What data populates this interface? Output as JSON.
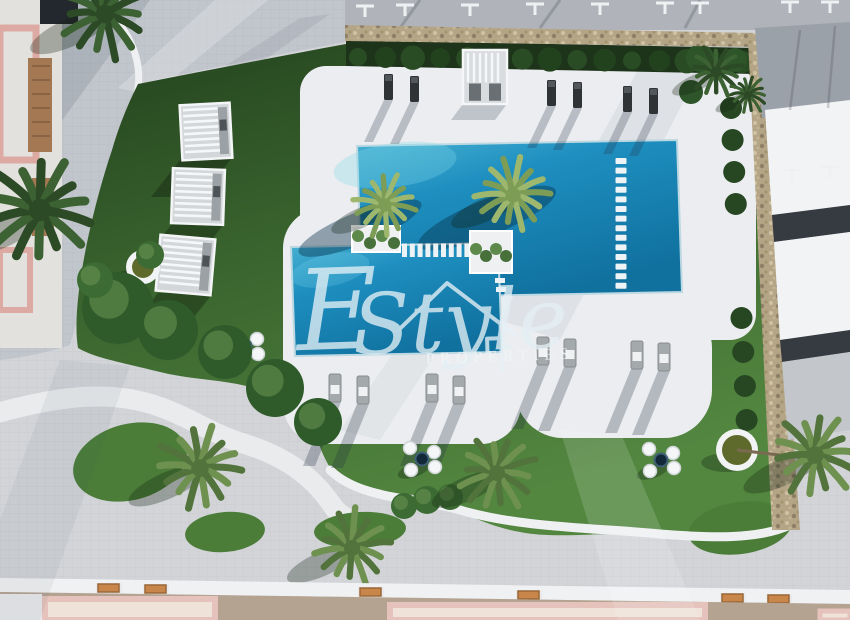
{
  "image": {
    "kind": "aerial-architectural-render",
    "subject": "residential community pool and garden, top-down view",
    "width": 850,
    "height": 620
  },
  "watermark": {
    "script_e": "E",
    "script_rest": "Style",
    "caption": "PROPERTIES",
    "icon": "house-outline-icon",
    "color": "#e4f0f5"
  },
  "palette": {
    "pavement": "#d2d4d8",
    "plaza": "#c1c6cc",
    "lawn_dark": "#2a4c24",
    "lawn_mid": "#3f6e32",
    "lawn_light": "#55893f",
    "hedge_dark": "#1d331a",
    "deck_white": "#ebedf0",
    "pool_deep": "#10719f",
    "pool_mid": "#1e8fc0",
    "pool_light": "#5ec1dd",
    "stone": "#b4a586",
    "stone_dark": "#8e8066",
    "stone_light": "#cfc2a3",
    "roof_gray": "#a9aeb5",
    "panel_white": "#f2f3f5",
    "band_dark": "#363b42",
    "rooftop_taupe": "#b5a392",
    "roof_pink": "#e5c2bb",
    "wood": "#c8864a",
    "lounger_dark": "#2f3336",
    "lounger_gray": "#a4a9ab",
    "palm_dark_a": "#3c6132",
    "palm_dark_b": "#2c4a26",
    "palm_mid_a": "#6f9150",
    "palm_mid_b": "#52743c",
    "palm_bright_a": "#9db86e",
    "palm_bright_b": "#7d9c55"
  },
  "scene": {
    "main_pool": {
      "points": "357,146 677,140 682,292 362,298"
    },
    "lower_pool": {
      "points": "291,247 498,243 502,352 295,356"
    },
    "ladder_pads": {
      "x": 615.5,
      "y0": 158,
      "step": 9.6,
      "count": 14,
      "w": 11,
      "h": 6
    },
    "junction_pads": {
      "x0": 402,
      "step": 7.8,
      "count": 10,
      "y": 243.5,
      "w": 5,
      "h": 13.5
    },
    "mini_pads": [
      [
        494,
        269
      ],
      [
        495,
        278
      ],
      [
        496,
        287
      ]
    ],
    "square_planters": [
      {
        "x": 352,
        "y": 226,
        "w": 48,
        "h": 26
      },
      {
        "x": 470,
        "y": 231,
        "w": 42,
        "h": 42
      }
    ],
    "round_planters": [
      {
        "x": 143,
        "y": 267,
        "r": 17
      },
      {
        "x": 737,
        "y": 450,
        "r": 21
      }
    ],
    "pergola_cubes": [
      {
        "x": 181,
        "y": 104,
        "w": 50,
        "h": 55,
        "rot": -3
      },
      {
        "x": 172,
        "y": 169,
        "w": 52,
        "h": 55,
        "rot": 2
      },
      {
        "x": 158,
        "y": 237,
        "w": 55,
        "h": 56,
        "rot": 5
      }
    ],
    "shower_cabin": {
      "x": 463,
      "y": 50,
      "w": 44,
      "h": 54
    },
    "dark_loungers": [
      [
        384,
        74
      ],
      [
        410,
        76
      ],
      [
        547,
        80
      ],
      [
        573,
        82
      ],
      [
        623,
        86
      ],
      [
        649,
        88
      ]
    ],
    "gray_loungers": [
      [
        329,
        374
      ],
      [
        357,
        376
      ],
      [
        426,
        374
      ],
      [
        453,
        376
      ],
      [
        537,
        337
      ],
      [
        564,
        339
      ],
      [
        631,
        341
      ],
      [
        658,
        343
      ]
    ],
    "pouf_clusters": [
      [
        245,
        346
      ],
      [
        422,
        459
      ],
      [
        661,
        460
      ]
    ],
    "hedge_row": {
      "x0": 358,
      "step": 27.4,
      "count": 15,
      "y": 57
    },
    "hedge_column_ys": [
      108,
      140,
      172,
      204,
      318,
      352,
      386,
      420
    ],
    "corner_bushes": [
      [
        700,
        58,
        14
      ],
      [
        735,
        60,
        12
      ],
      [
        691,
        92,
        12
      ]
    ],
    "lawn_bushes": [
      [
        118,
        308,
        36
      ],
      [
        168,
        330,
        30
      ],
      [
        225,
        352,
        27
      ],
      [
        275,
        388,
        29
      ],
      [
        318,
        422,
        24
      ],
      [
        150,
        255,
        14
      ],
      [
        95,
        280,
        18
      ],
      [
        404,
        506,
        13
      ],
      [
        427,
        500,
        14
      ],
      [
        450,
        497,
        13
      ]
    ],
    "grass_blobs": [
      [
        130,
        462,
        58,
        38,
        -15
      ],
      [
        740,
        528,
        52,
        26,
        -8
      ],
      [
        225,
        532,
        40,
        20,
        -5
      ],
      [
        360,
        530,
        46,
        18,
        -3
      ]
    ],
    "palms": [
      {
        "x": 105,
        "y": 14,
        "r": 46,
        "tone": "dark"
      },
      {
        "x": 40,
        "y": 210,
        "r": 56,
        "tone": "dark"
      },
      {
        "x": 200,
        "y": 468,
        "r": 44,
        "tone": "mid"
      },
      {
        "x": 352,
        "y": 548,
        "r": 40,
        "tone": "mid"
      },
      {
        "x": 497,
        "y": 473,
        "r": 40,
        "tone": "mid"
      },
      {
        "x": 815,
        "y": 455,
        "r": 44,
        "tone": "mid"
      },
      {
        "x": 385,
        "y": 205,
        "r": 33,
        "tone": "bright"
      },
      {
        "x": 513,
        "y": 195,
        "r": 38,
        "tone": "bright"
      },
      {
        "x": 716,
        "y": 72,
        "r": 27,
        "tone": "dark"
      },
      {
        "x": 748,
        "y": 95,
        "r": 20,
        "tone": "dark"
      }
    ],
    "benches": [
      [
        98,
        584
      ],
      [
        145,
        585
      ],
      [
        360,
        588
      ],
      [
        518,
        591
      ],
      [
        722,
        594
      ],
      [
        768,
        595
      ]
    ],
    "t_marks_top": [
      [
        365,
        6
      ],
      [
        405,
        5
      ],
      [
        470,
        5
      ],
      [
        535,
        4
      ],
      [
        600,
        4
      ],
      [
        665,
        3
      ],
      [
        700,
        3
      ],
      [
        790,
        2
      ],
      [
        830,
        2
      ]
    ],
    "t_marks_right": [
      [
        792,
        170
      ],
      [
        830,
        167
      ]
    ]
  }
}
